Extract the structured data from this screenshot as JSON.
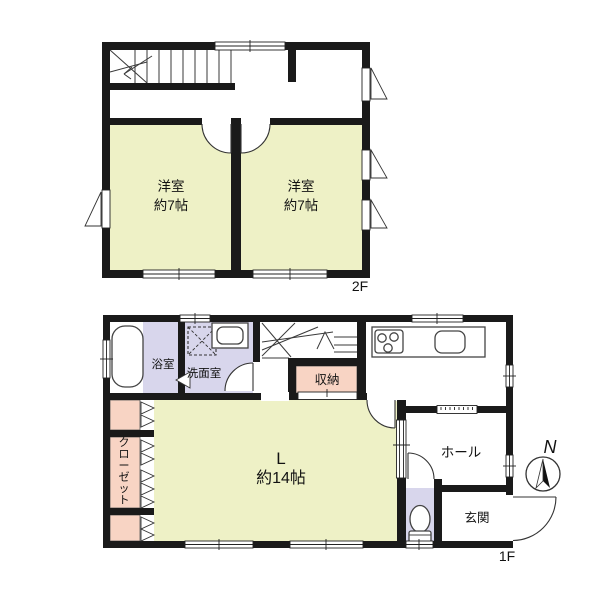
{
  "colors": {
    "room_yellow": "#eef1c6",
    "wet_lavender": "#d8d6ec",
    "storage_pink": "#f8d4c4",
    "wall_black": "#1a1a1a"
  },
  "floor2": {
    "label": "2F",
    "rooms": [
      {
        "name": "洋室",
        "size": "約7帖"
      },
      {
        "name": "洋室",
        "size": "約7帖"
      }
    ]
  },
  "floor1": {
    "label": "1F",
    "bathroom": "浴室",
    "washroom": "洗面室",
    "storage": "収納",
    "closet": "クローゼット",
    "living": {
      "name": "L",
      "size": "約14帖"
    },
    "hall": "ホール",
    "entrance": "玄関",
    "compass": "N"
  }
}
